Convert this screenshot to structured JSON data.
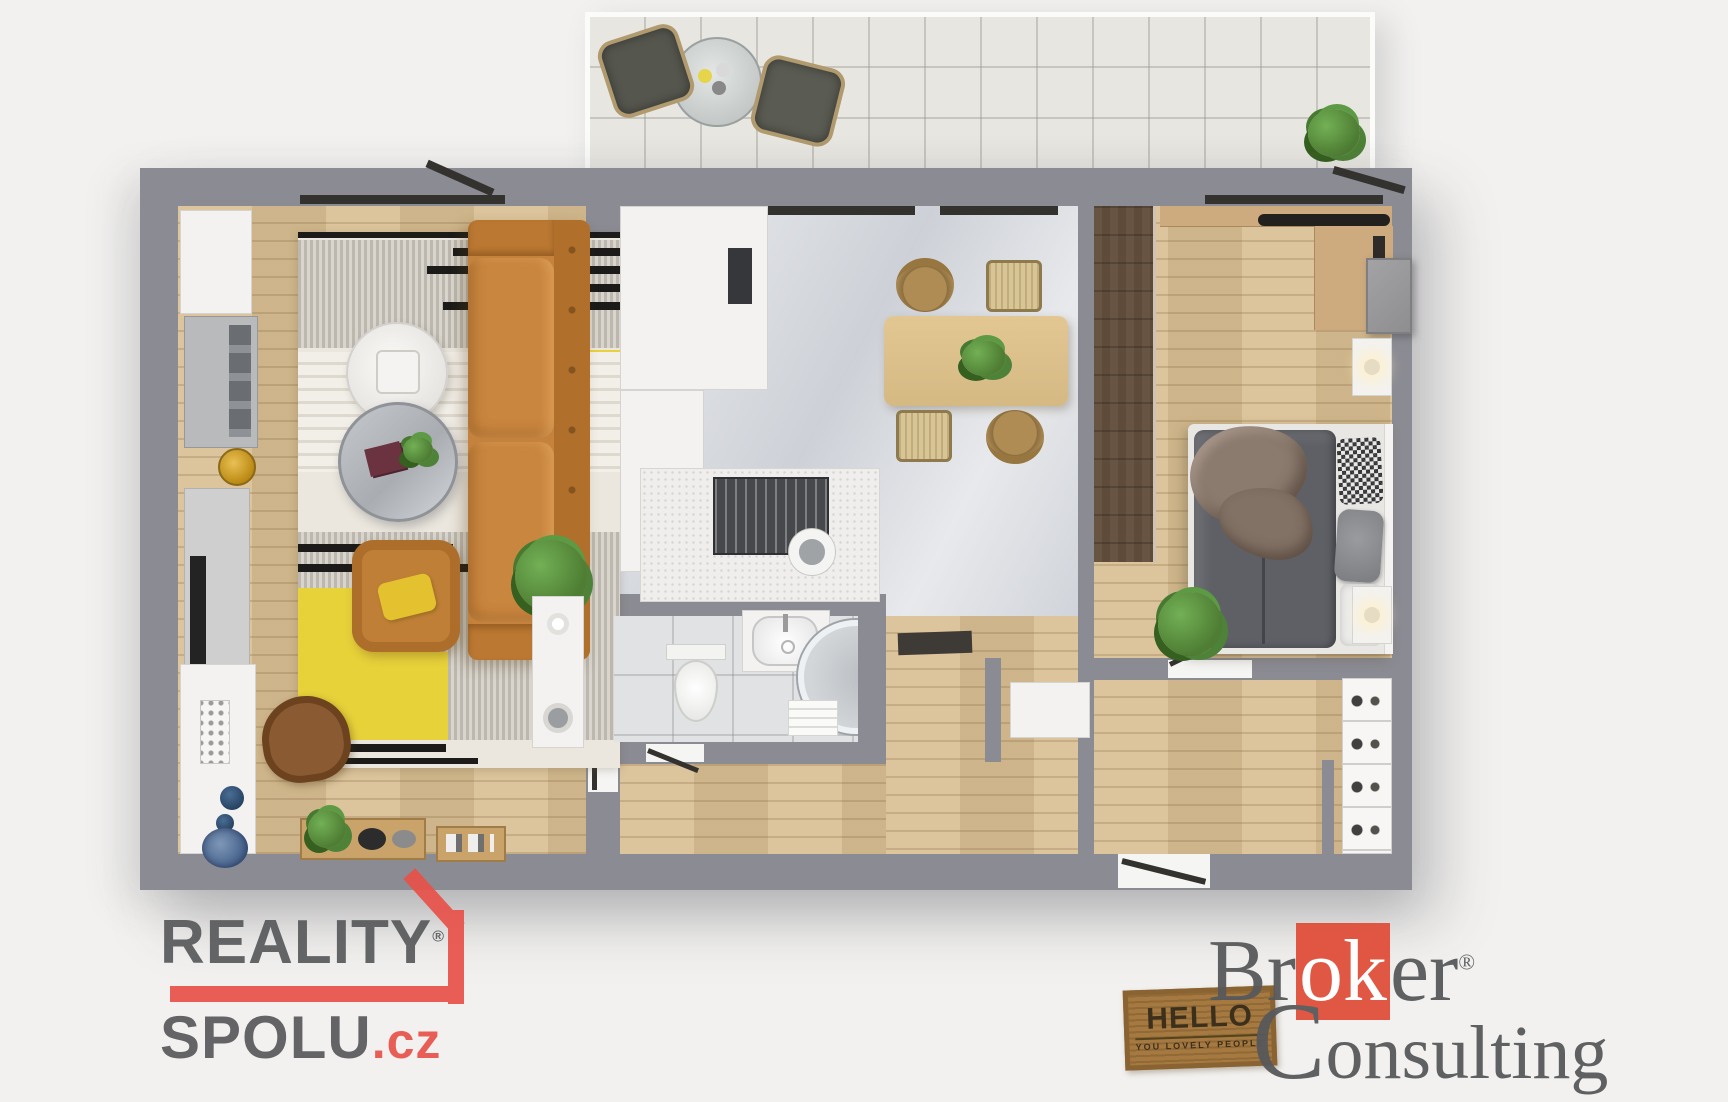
{
  "branding": {
    "reality_spolu": {
      "line1": "REALITY",
      "registered": "®",
      "line2_main": "SPOLU",
      "line2_suffix": ".cz"
    },
    "broker_consulting": {
      "word1_start": "Br",
      "word1_highlight": "ok",
      "word1_end": "er",
      "registered": "®",
      "word2": "Consulting"
    }
  },
  "doormat": {
    "line1": "HELLO",
    "line2": "YOU LOVELY PEOPLE"
  },
  "colors": {
    "background": "#f2f1ef",
    "wall": "#8b8b93",
    "wood": "#d9c094",
    "wood_dark": "#5f4b39",
    "marble": "#d4d7dc",
    "bath_tile": "#e0e2e3",
    "balcony_tile": "#e8e6e1",
    "sofa": "#c5823c",
    "rug_yellow": "#e8d23a",
    "bed_duvet": "#5e6066",
    "blanket": "#8b7a6e",
    "plant": "#4e7d33",
    "logo_gray": "#58595b",
    "logo_red": "#e8524a",
    "broker_red": "#e04f3a",
    "mat_brown": "#a5793f"
  }
}
